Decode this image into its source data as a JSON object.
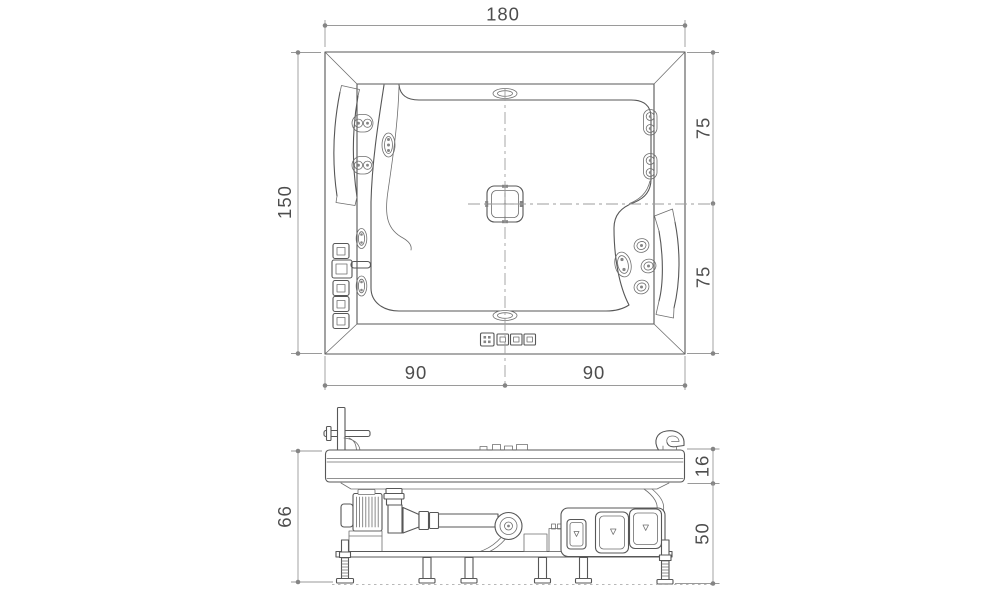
{
  "figure": {
    "type": "technical-drawing",
    "subject": "whirlpool bathtub - top plan view and side elevation",
    "colors": {
      "background": "#ffffff",
      "object_line": "#575757",
      "dimension_line": "#9a9a9a",
      "dimension_text": "#4d4d4d"
    }
  },
  "dims": {
    "plan": {
      "width": "180",
      "height": "150",
      "right_upper": "75",
      "right_lower": "75",
      "bottom_left": "90",
      "bottom_right": "90"
    },
    "side": {
      "total_height": "66",
      "rim_thickness": "16",
      "base_height": "50"
    }
  }
}
